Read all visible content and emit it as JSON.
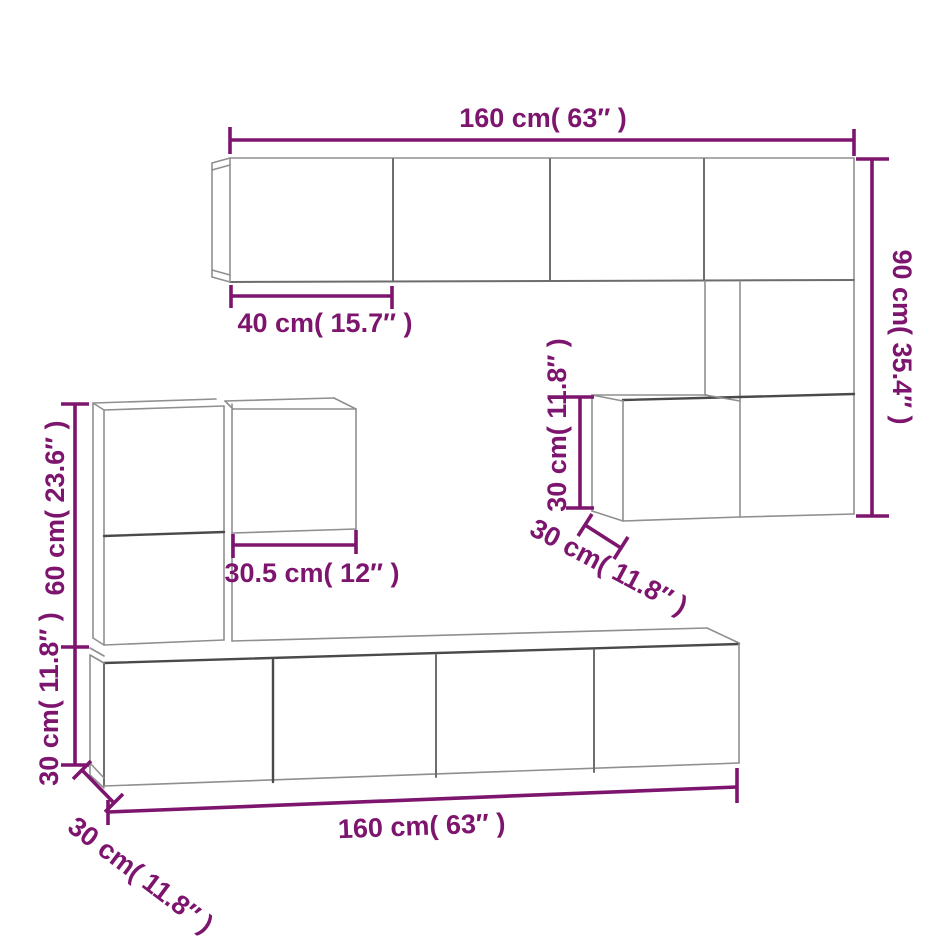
{
  "diagram": {
    "title": "TV wall cabinet set dimension diagram",
    "accent_color": "#7d156e",
    "line_color": "#8f8f8f",
    "dark_line_color": "#4a4a4a",
    "background_color": "#ffffff",
    "dimensions": {
      "top_width": "160 cm( 63″ )",
      "top_door_width": "40 cm( 15.7″ )",
      "right_height": "90 cm( 35.4″ )",
      "mid_cube_height": "30 cm( 11.8″ )",
      "mid_cube_depth": "30 cm( 11.8″ )",
      "left_cube_width": "30.5 cm( 12″ )",
      "left_upper_height": "60 cm( 23.6″ )",
      "left_lower_height": "30 cm( 11.8″ )",
      "bottom_depth": "30 cm( 11.8″ )",
      "bottom_width": "160 cm( 63″ )"
    }
  }
}
